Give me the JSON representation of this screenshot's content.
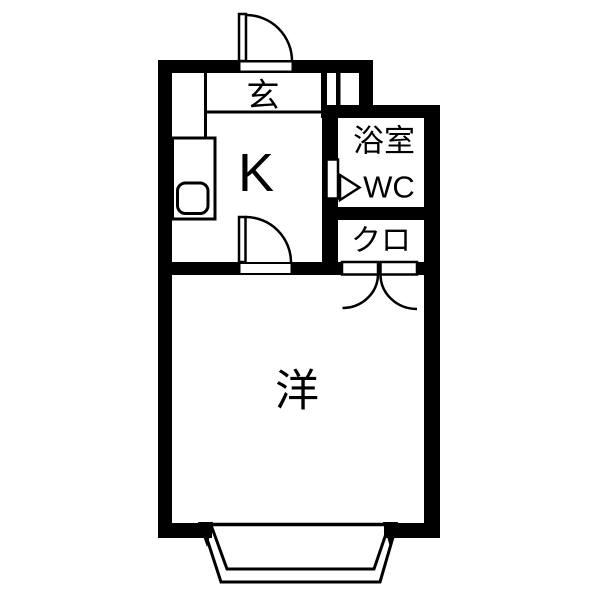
{
  "plan": {
    "type": "floor-plan",
    "colors": {
      "line": "#000000",
      "background": "#ffffff"
    },
    "rooms": {
      "genkan": {
        "label": "玄"
      },
      "kitchen": {
        "label": "K"
      },
      "bathroom": {
        "label_line1": "浴室",
        "label_line2": "WC"
      },
      "closet": {
        "label": "クロ"
      },
      "western_room": {
        "label": "洋"
      }
    }
  }
}
